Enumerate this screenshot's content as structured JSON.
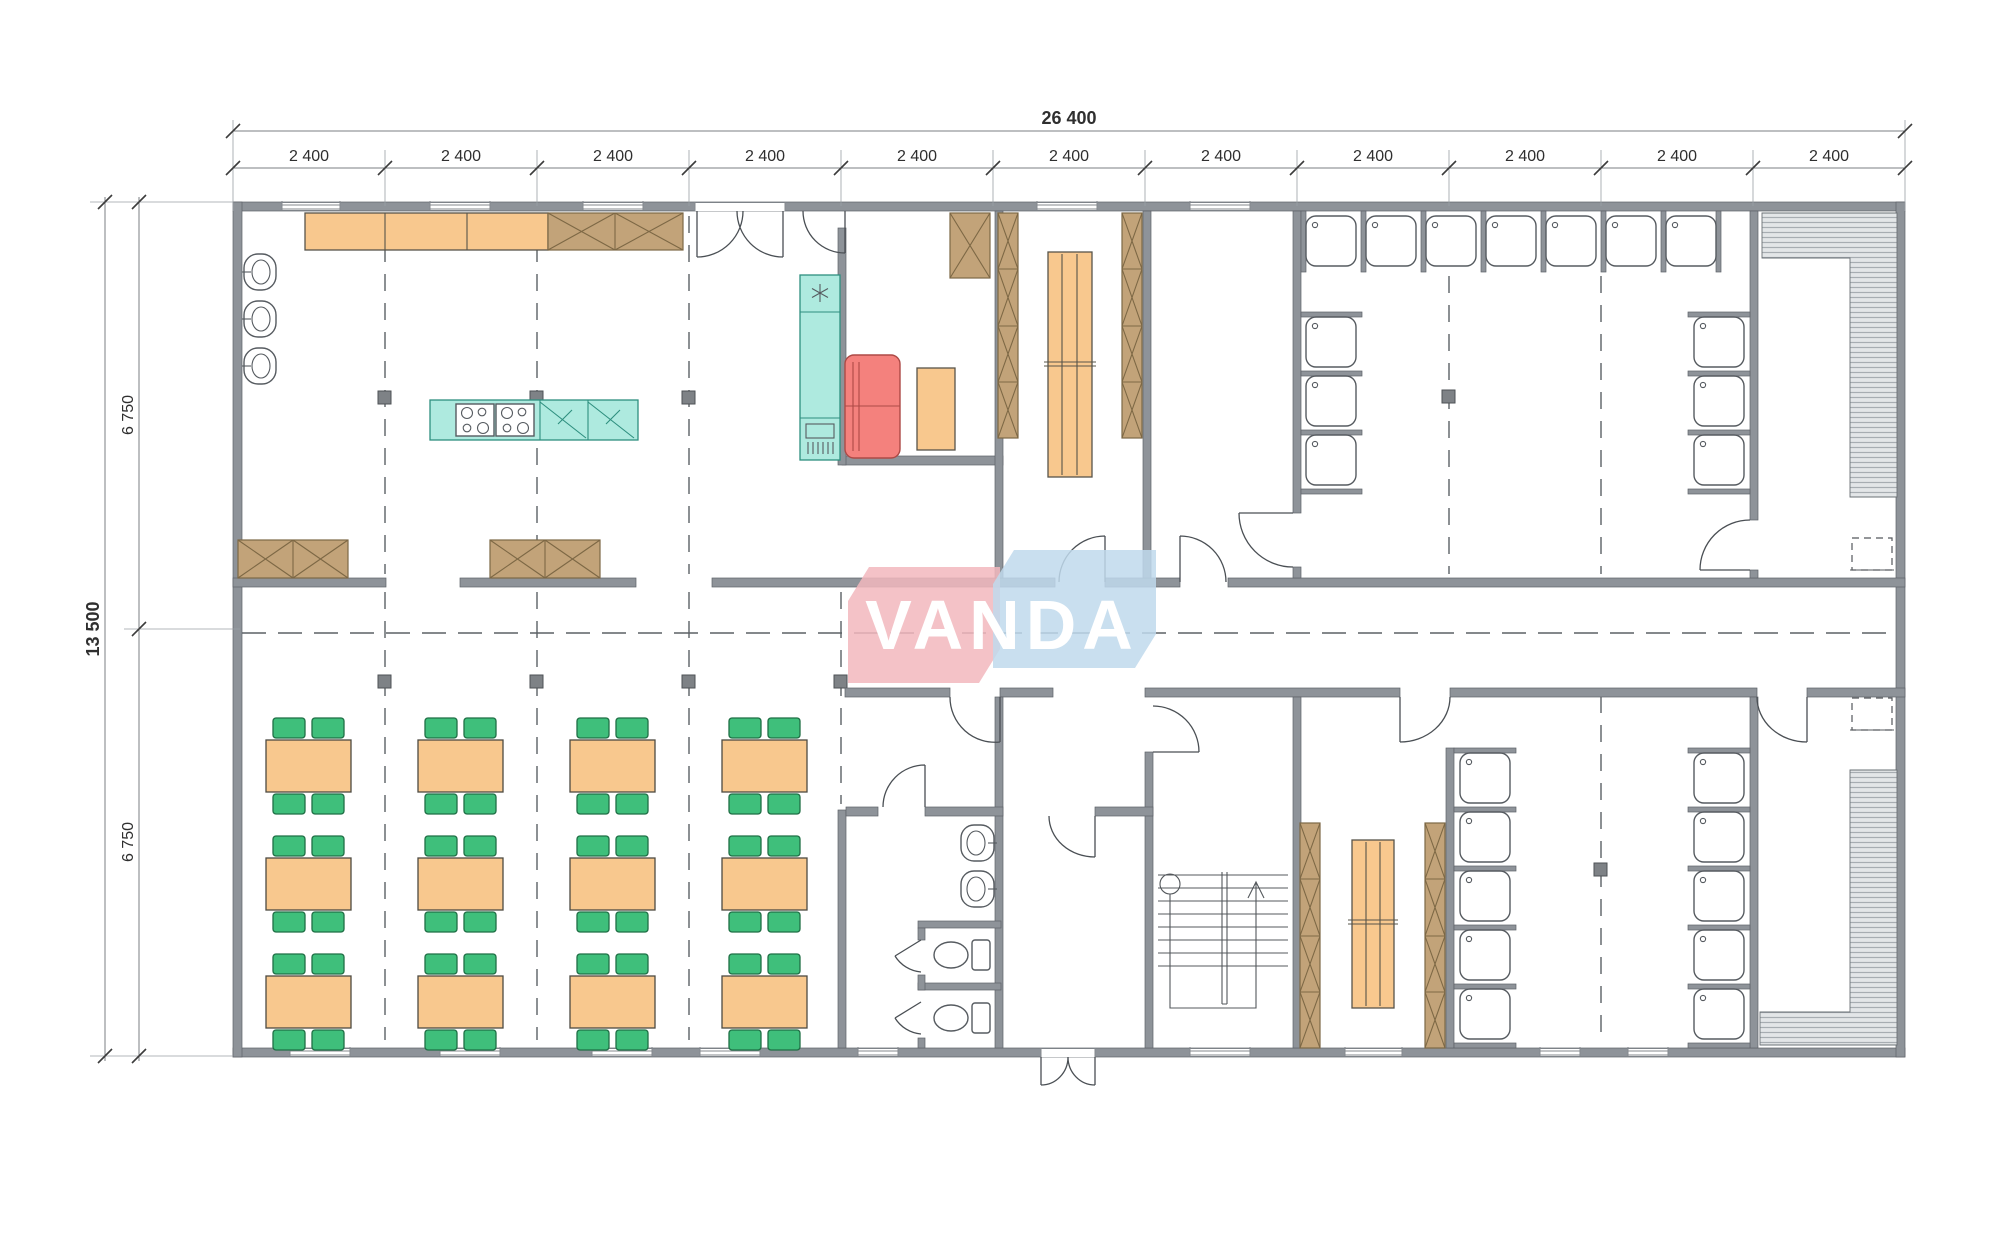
{
  "drawing": {
    "type": "floor-plan",
    "watermark": "VANDA"
  },
  "dimensions": {
    "top_total": "26 400",
    "top_segments": [
      "2 400",
      "2 400",
      "2 400",
      "2 400",
      "2 400",
      "2 400",
      "2 400",
      "2 400",
      "2 400",
      "2 400",
      "2 400"
    ],
    "left_total": "13 500",
    "left_segments": [
      "6 750",
      "6 750"
    ]
  },
  "colors": {
    "paper": "#ffffff",
    "wall": "#8e9399",
    "wallStroke": "#5e6268",
    "line": "#4a4f54",
    "dim": "#2f2f2f",
    "orange": "#f8c88e",
    "orangeStroke": "#57544a",
    "brown": "#c2a379",
    "brownStroke": "#7d6845",
    "teal": "#aeeadf",
    "tealStroke": "#2e8f7f",
    "red": "#f4817d",
    "redStroke": "#ad4a46",
    "green": "#3fbf7b",
    "greenStroke": "#1f6f45",
    "column": "#7e8286",
    "hatchBg": "#e3e6e8",
    "hatchLine": "#a7adb2",
    "logoPink": "#f2b7bd",
    "logoBlue": "#bfd9ec",
    "logoText": "#ffffff"
  }
}
